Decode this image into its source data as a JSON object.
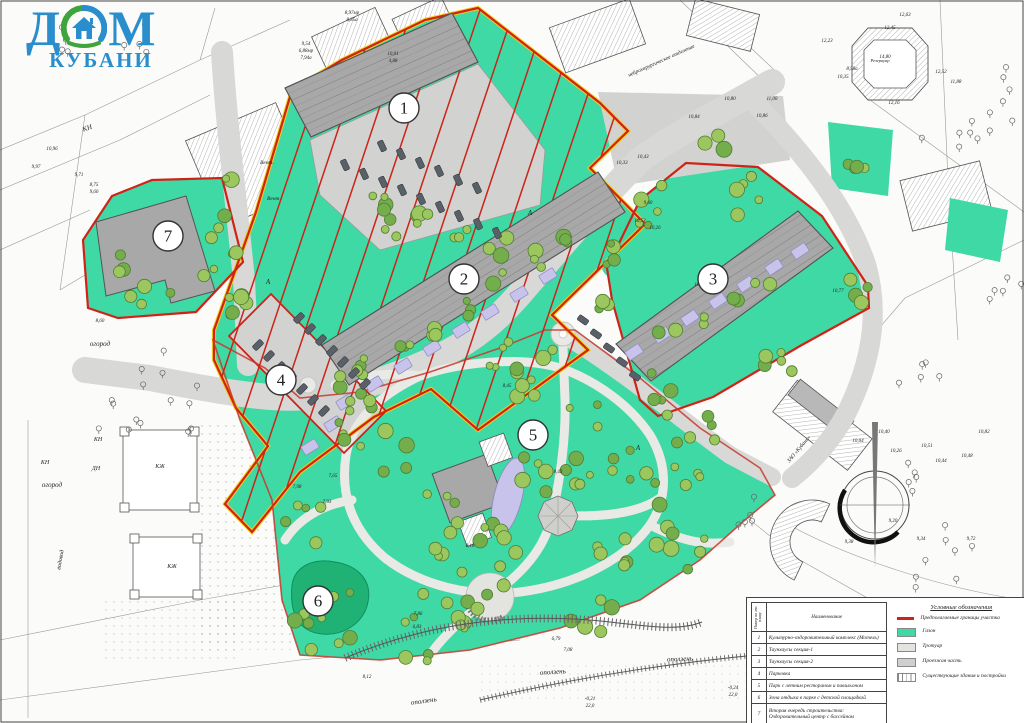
{
  "logo": {
    "word1": "ДОМ",
    "word2": "КУБАНИ",
    "blue": "#2a8ecd",
    "green": "#3ea43b"
  },
  "zone_markers": [
    {
      "n": "1",
      "x": 404,
      "y": 108
    },
    {
      "n": "2",
      "x": 464,
      "y": 279
    },
    {
      "n": "3",
      "x": 713,
      "y": 279
    },
    {
      "n": "4",
      "x": 281,
      "y": 380
    },
    {
      "n": "5",
      "x": 533,
      "y": 435
    },
    {
      "n": "6",
      "x": 318,
      "y": 601
    },
    {
      "n": "7",
      "x": 168,
      "y": 236
    }
  ],
  "legend_table": {
    "col_num": "Номер по ген. плану",
    "col_name": "Наименование",
    "rows": [
      {
        "n": "1",
        "name": "Культурно-оздоровительный комплекс (Мотель)"
      },
      {
        "n": "2",
        "name": "Таунхаусы секция-1"
      },
      {
        "n": "3",
        "name": "Таунхаусы секция-2"
      },
      {
        "n": "4",
        "name": "Парковка"
      },
      {
        "n": "5",
        "name": "Парк с летним рестораном и павильоном"
      },
      {
        "n": "6",
        "name": "Зона отдыха в парке с детской площадкой"
      },
      {
        "n": "7",
        "name": "Вторая очередь строительства:\nОздоровительный центр с бассейном"
      }
    ]
  },
  "legend_symbols": {
    "title": "Условные обозначения",
    "items": [
      {
        "kind": "line",
        "color": "#cf2318",
        "label": "Предполагаемые границы участка"
      },
      {
        "kind": "swatch",
        "color": "#3fd9a6",
        "label": "Газон"
      },
      {
        "kind": "swatch",
        "color": "#e3e3df",
        "label": "Тротуар"
      },
      {
        "kind": "swatch",
        "color": "#cfcfcd",
        "label": "Проезжая часть"
      },
      {
        "kind": "hatch",
        "color": "#ffffff",
        "label": "Существующие здания и постройки"
      }
    ]
  },
  "colors": {
    "lawn": "#3fd9a6",
    "pond": "#1fb274",
    "boundary_red": "#cf2318",
    "boundary_yellow": "#f2ce1b",
    "road": "#d8d8d7",
    "path": "#e9e9e5",
    "building": "#a8a8a8",
    "pool": "#c7c3ea",
    "tree_fill": "#9cc75e",
    "tree_stroke": "#4f7d33",
    "car": "#5a6068"
  },
  "map_labels": [
    [
      "оползень",
      424,
      703,
      -8,
      7
    ],
    [
      "оползень",
      553,
      674,
      -4,
      7
    ],
    [
      "оползень",
      680,
      661,
      -2,
      7
    ],
    [
      "огород",
      100,
      346,
      0,
      7
    ],
    [
      "огород",
      52,
      487,
      0,
      7
    ],
    [
      "водовод",
      62,
      560,
      -80,
      6
    ],
    [
      "КЖ",
      160,
      468,
      0,
      6
    ],
    [
      "КЖ",
      172,
      568,
      0,
      6
    ],
    [
      "КН",
      98,
      441,
      0,
      6
    ],
    [
      "ДН",
      96,
      470,
      0,
      6
    ],
    [
      "КН",
      88,
      130,
      -20,
      7
    ],
    [
      "КН",
      45,
      464,
      0,
      6
    ],
    [
      "Вент.",
      267,
      164,
      0,
      5.5
    ],
    [
      "Вент.",
      274,
      200,
      0,
      5.5
    ],
    [
      "нейрохирургическое отделение",
      662,
      62,
      -24,
      5.5
    ],
    [
      "ЗАО «Кубань»",
      800,
      450,
      -50,
      5.5
    ],
    [
      "Резервуар",
      880,
      62,
      0,
      4.5
    ],
    [
      "А",
      530,
      215,
      0,
      7
    ],
    [
      "А",
      268,
      284,
      0,
      7
    ],
    [
      "А",
      638,
      450,
      0,
      7
    ],
    [
      "9,97",
      36,
      168,
      0,
      5
    ],
    [
      "10,96",
      52,
      150,
      0,
      5
    ],
    [
      "9,71",
      79,
      176,
      0,
      5
    ],
    [
      "8,75",
      94,
      186,
      0,
      5
    ],
    [
      "9,60",
      94,
      193,
      0,
      5
    ],
    [
      "9,54",
      306,
      45,
      0,
      5
    ],
    [
      "6,88мр",
      306,
      52,
      0,
      5
    ],
    [
      "7,94а",
      306,
      59,
      0,
      5
    ],
    [
      "8,97мр",
      352,
      14,
      0,
      5
    ],
    [
      "8,85а",
      352,
      21,
      0,
      5
    ],
    [
      "10,01",
      393,
      55,
      0,
      5
    ],
    [
      "4,88",
      393,
      62,
      0,
      5
    ],
    [
      "10,84",
      694,
      118,
      0,
      5
    ],
    [
      "10,86",
      762,
      117,
      0,
      5
    ],
    [
      "10,80",
      730,
      100,
      0,
      5
    ],
    [
      "11,00",
      772,
      100,
      0,
      5
    ],
    [
      "10,33",
      622,
      164,
      0,
      5
    ],
    [
      "10,43",
      643,
      158,
      0,
      5
    ],
    [
      "10,26",
      655,
      229,
      0,
      5
    ],
    [
      "10,53",
      640,
      222,
      0,
      5
    ],
    [
      "10,25",
      700,
      286,
      0,
      5
    ],
    [
      "9,60",
      648,
      204,
      0,
      5
    ],
    [
      "12,23",
      827,
      42,
      0,
      5
    ],
    [
      "12,45",
      890,
      29,
      0,
      5
    ],
    [
      "12,63",
      905,
      16,
      0,
      5
    ],
    [
      "14,80",
      885,
      58,
      0,
      5
    ],
    [
      "12,52",
      941,
      73,
      0,
      5
    ],
    [
      "11,88",
      956,
      83,
      0,
      5
    ],
    [
      "12,16",
      894,
      104,
      0,
      5
    ],
    [
      "8,58а",
      852,
      70,
      0,
      5
    ],
    [
      "10,35",
      843,
      78,
      0,
      5
    ],
    [
      "10,77",
      838,
      292,
      0,
      5
    ],
    [
      "10,40",
      884,
      433,
      0,
      5
    ],
    [
      "10,26",
      896,
      452,
      0,
      5
    ],
    [
      "10,04",
      858,
      442,
      0,
      5
    ],
    [
      "10,51",
      927,
      447,
      0,
      5
    ],
    [
      "10,44",
      941,
      462,
      0,
      5
    ],
    [
      "10,48",
      967,
      457,
      0,
      5
    ],
    [
      "10,82",
      984,
      433,
      0,
      5
    ],
    [
      "9,20",
      893,
      522,
      0,
      5
    ],
    [
      "9,34",
      921,
      540,
      0,
      5
    ],
    [
      "9,72",
      971,
      540,
      0,
      5
    ],
    [
      "9,38",
      849,
      543,
      0,
      5
    ],
    [
      "8,45",
      507,
      387,
      0,
      5
    ],
    [
      "8,43",
      558,
      473,
      0,
      5
    ],
    [
      "8,10",
      470,
      547,
      0,
      5
    ],
    [
      "7,86",
      418,
      615,
      0,
      5
    ],
    [
      "6,83",
      417,
      628,
      0,
      5
    ],
    [
      "7,93",
      327,
      503,
      0,
      5
    ],
    [
      "7,98",
      297,
      488,
      0,
      5
    ],
    [
      "7,65",
      333,
      477,
      0,
      5
    ],
    [
      "8,60",
      100,
      322,
      0,
      5
    ],
    [
      "8,12",
      367,
      678,
      0,
      5
    ],
    [
      "6,79",
      556,
      640,
      0,
      5
    ],
    [
      "7,08",
      568,
      651,
      0,
      5
    ],
    [
      "-0,21",
      590,
      700,
      0,
      5
    ],
    [
      "22,0",
      590,
      707,
      0,
      5
    ],
    [
      "-0,24",
      733,
      689,
      0,
      5
    ],
    [
      "22,0",
      733,
      696,
      0,
      5
    ],
    [
      "-0,24",
      1003,
      660,
      0,
      5
    ],
    [
      "22,0",
      1003,
      667,
      0,
      5
    ]
  ],
  "trees": {
    "clusters": [
      [
        380,
        420,
        55,
        12
      ],
      [
        470,
        575,
        55,
        12
      ],
      [
        625,
        470,
        55,
        12
      ],
      [
        560,
        385,
        45,
        9
      ],
      [
        680,
        545,
        35,
        7
      ],
      [
        325,
        612,
        42,
        9
      ],
      [
        300,
        525,
        28,
        5
      ],
      [
        432,
        632,
        38,
        8
      ],
      [
        700,
        435,
        26,
        5
      ],
      [
        545,
        470,
        30,
        6
      ],
      [
        610,
        560,
        30,
        6
      ],
      [
        692,
        470,
        18,
        4
      ],
      [
        350,
        385,
        20,
        4
      ],
      [
        505,
        360,
        22,
        5
      ],
      [
        590,
        612,
        25,
        5
      ],
      [
        395,
        215,
        22,
        5
      ],
      [
        612,
        245,
        20,
        4
      ],
      [
        230,
        300,
        22,
        4
      ],
      [
        150,
        297,
        22,
        4
      ],
      [
        218,
        228,
        14,
        3
      ],
      [
        712,
        146,
        14,
        3
      ],
      [
        860,
        162,
        18,
        4
      ],
      [
        648,
        207,
        26,
        5
      ],
      [
        757,
        200,
        26,
        5
      ],
      [
        848,
        290,
        20,
        4
      ],
      [
        782,
        362,
        24,
        5
      ],
      [
        664,
        392,
        24,
        5
      ],
      [
        613,
        302,
        16,
        3
      ],
      [
        440,
        520,
        30,
        6
      ],
      [
        490,
        545,
        25,
        5
      ],
      [
        365,
        370,
        12,
        3
      ],
      [
        400,
        348,
        12,
        3
      ],
      [
        435,
        326,
        12,
        3
      ],
      [
        470,
        304,
        12,
        3
      ],
      [
        505,
        282,
        12,
        3
      ],
      [
        540,
        260,
        12,
        3
      ],
      [
        575,
        238,
        12,
        3
      ],
      [
        380,
        205,
        12,
        3
      ],
      [
        420,
        222,
        12,
        3
      ],
      [
        460,
        236,
        12,
        3
      ],
      [
        500,
        247,
        12,
        3
      ],
      [
        668,
        330,
        10,
        2
      ],
      [
        700,
        315,
        10,
        2
      ],
      [
        732,
        300,
        10,
        2
      ],
      [
        764,
        285,
        10,
        2
      ],
      [
        225,
        180,
        10,
        2
      ],
      [
        232,
        245,
        10,
        2
      ],
      [
        238,
        305,
        10,
        2
      ],
      [
        112,
        262,
        16,
        3
      ],
      [
        205,
        275,
        12,
        2
      ]
    ]
  },
  "outline_trees": {
    "clusters": [
      [
        995,
        95,
        40,
        8
      ],
      [
        950,
        135,
        30,
        6
      ],
      [
        1004,
        300,
        28,
        5
      ],
      [
        940,
        560,
        40,
        8
      ],
      [
        985,
        625,
        30,
        6
      ],
      [
        900,
        475,
        28,
        5
      ],
      [
        175,
        390,
        45,
        9
      ],
      [
        120,
        425,
        30,
        6
      ],
      [
        60,
        45,
        22,
        4
      ],
      [
        140,
        45,
        22,
        4
      ],
      [
        760,
        520,
        25,
        5
      ],
      [
        920,
        380,
        25,
        5
      ]
    ]
  },
  "cars": [
    [
      345,
      165,
      65
    ],
    [
      364,
      174,
      65
    ],
    [
      383,
      182,
      65
    ],
    [
      402,
      190,
      65
    ],
    [
      421,
      199,
      65
    ],
    [
      440,
      207,
      65
    ],
    [
      459,
      216,
      65
    ],
    [
      478,
      224,
      65
    ],
    [
      497,
      233,
      65
    ],
    [
      382,
      146,
      65
    ],
    [
      401,
      154,
      65
    ],
    [
      420,
      163,
      65
    ],
    [
      439,
      171,
      65
    ],
    [
      458,
      180,
      65
    ],
    [
      477,
      188,
      65
    ],
    [
      583,
      320,
      35
    ],
    [
      596,
      334,
      35
    ],
    [
      609,
      348,
      35
    ],
    [
      622,
      362,
      35
    ],
    [
      635,
      376,
      35
    ],
    [
      258,
      345,
      -45
    ],
    [
      269,
      356,
      -45
    ],
    [
      280,
      367,
      -45
    ],
    [
      291,
      378,
      -45
    ],
    [
      302,
      389,
      -45
    ],
    [
      313,
      400,
      -45
    ],
    [
      324,
      411,
      -45
    ],
    [
      299,
      318,
      -45
    ],
    [
      310,
      329,
      -45
    ],
    [
      321,
      340,
      -45
    ],
    [
      332,
      351,
      -45
    ],
    [
      343,
      362,
      -45
    ],
    [
      354,
      373,
      -45
    ],
    [
      365,
      384,
      -45
    ]
  ],
  "pools": [
    [
      345,
      402,
      58
    ],
    [
      374,
      384,
      58
    ],
    [
      403,
      366,
      58
    ],
    [
      432,
      348,
      58
    ],
    [
      461,
      330,
      58
    ],
    [
      490,
      312,
      58
    ],
    [
      519,
      294,
      58
    ],
    [
      548,
      276,
      58
    ],
    [
      333,
      424,
      58
    ],
    [
      310,
      447,
      58
    ],
    [
      634,
      352,
      56
    ],
    [
      662,
      335,
      56
    ],
    [
      690,
      318,
      56
    ],
    [
      718,
      301,
      56
    ],
    [
      746,
      284,
      56
    ],
    [
      774,
      267,
      56
    ],
    [
      800,
      251,
      56
    ]
  ]
}
